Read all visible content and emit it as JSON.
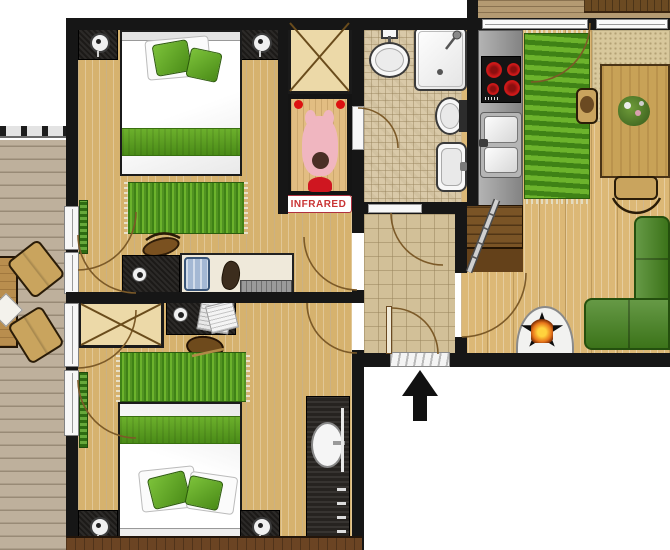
{
  "plan": {
    "labels": {
      "sauna": "INFRARED"
    },
    "entrance": {
      "arrow_direction": "up"
    },
    "colors": {
      "wall": "#161616",
      "wood": "#d6b26e",
      "deck": "#beb09c",
      "balcony": "#b49a72",
      "tile_sm": "#d9c9a8",
      "tile_lg": "#d2c098",
      "rug_dark": "#3f8216",
      "rug_light": "#6cb32c",
      "sofa_green": "#44831d",
      "band_green_1": "#6cb02c",
      "band_green_2": "#4a8b17",
      "counter": "#9a9a9a",
      "burner_red": "#d31a1a",
      "stairs_brown": "#7a5426",
      "tan": "#c9a45e",
      "cab_black": "#1c1a18",
      "label_red": "#c93434",
      "flame": "#e8751a",
      "pink": "#f0b6c0",
      "sill": "#6b4423"
    }
  }
}
